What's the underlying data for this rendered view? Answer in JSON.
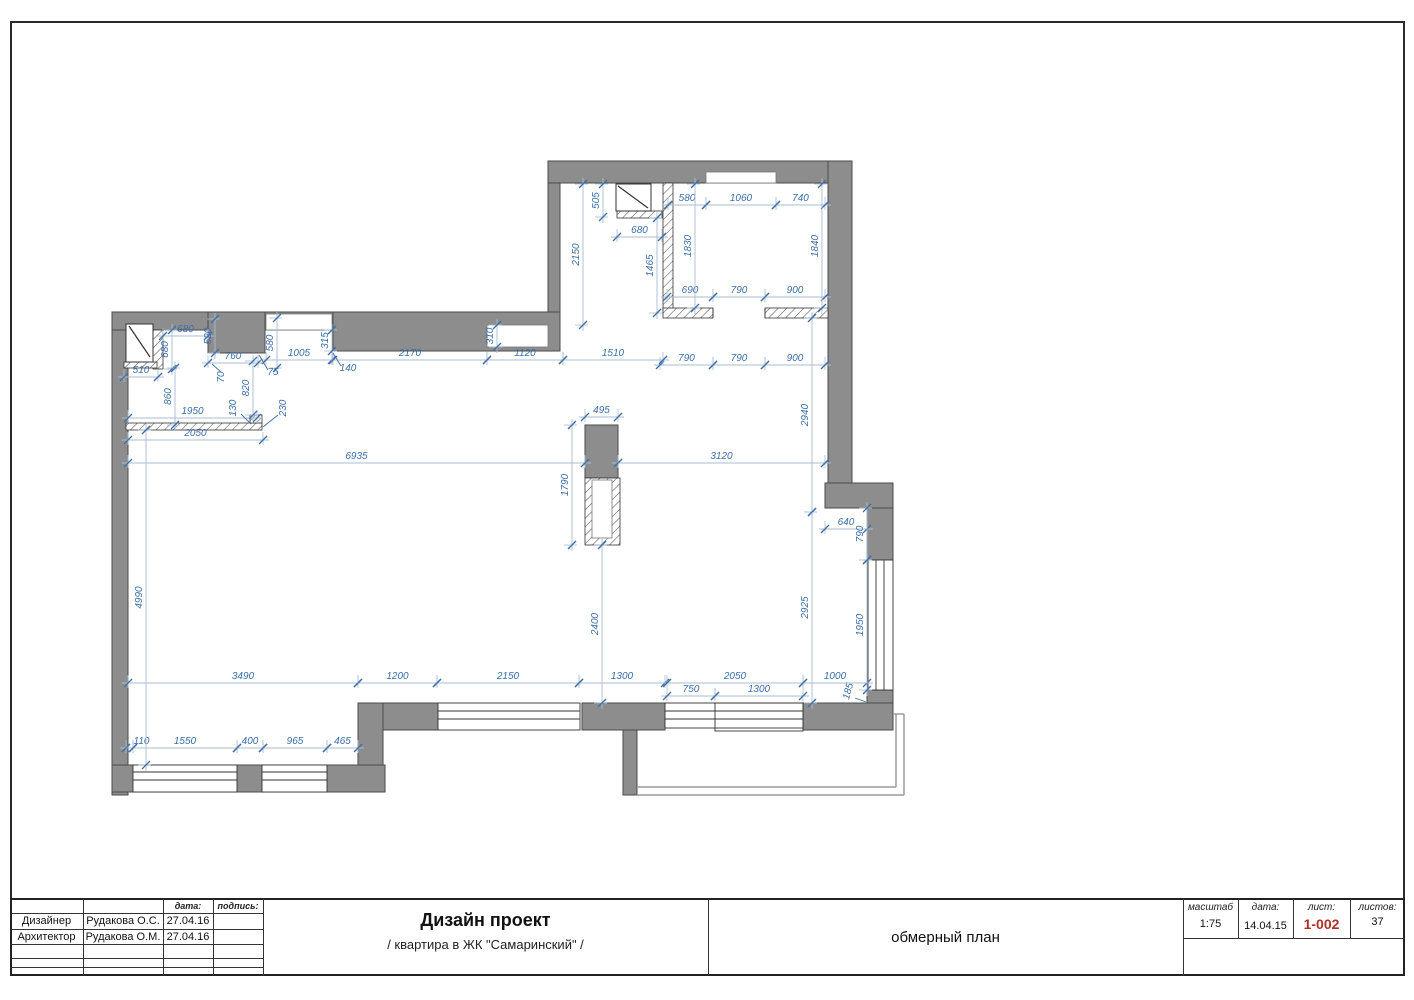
{
  "drawing": {
    "colors": {
      "wall_fill": "#8d8d8d",
      "wall_stroke": "#4a4a4a",
      "hatch_stroke": "#555555",
      "dim_text": "#3a6ea8",
      "dim_line": "#a9bdd3",
      "tick": "#3d6fa8",
      "balcony_line": "#9a9a9a",
      "thin_black": "#333333",
      "sheet_number_red": "#b03028"
    },
    "plan": {
      "walls": [
        [
          112,
          312,
          16,
          483
        ],
        [
          112,
          312,
          221,
          18
        ],
        [
          208,
          312,
          57,
          41
        ],
        [
          333,
          312,
          227,
          39
        ],
        [
          548,
          161,
          12,
          151
        ],
        [
          548,
          161,
          304,
          22
        ],
        [
          828,
          161,
          24,
          322
        ],
        [
          825,
          483,
          68,
          25
        ],
        [
          867,
          508,
          26,
          52
        ],
        [
          867,
          690,
          26,
          13
        ],
        [
          803,
          703,
          90,
          27
        ],
        [
          582,
          703,
          83,
          27
        ],
        [
          623,
          730,
          14,
          65
        ],
        [
          358,
          703,
          80,
          27
        ],
        [
          358,
          703,
          25,
          89
        ],
        [
          112,
          765,
          273,
          27
        ],
        [
          585,
          425,
          33,
          53
        ]
      ],
      "hatched": [
        [
          153,
          330,
          10,
          39
        ],
        [
          124,
          362,
          33,
          6
        ],
        [
          126,
          423,
          136,
          7
        ],
        [
          250,
          415,
          12,
          8
        ],
        [
          663,
          183,
          10,
          130
        ],
        [
          617,
          211,
          45,
          7
        ],
        [
          663,
          308,
          50,
          10
        ],
        [
          765,
          308,
          63,
          10
        ],
        [
          585,
          478,
          35,
          67
        ]
      ],
      "insets": [
        [
          266,
          314,
          66,
          16
        ],
        [
          487,
          325,
          61,
          22
        ],
        [
          706,
          172,
          70,
          11
        ],
        [
          592,
          480,
          20,
          58
        ]
      ],
      "windows": [
        {
          "type": "h",
          "x1": 133,
          "x2": 237,
          "y1": 765,
          "y2": 792,
          "lines": [
            772,
            780
          ]
        },
        {
          "type": "h",
          "x1": 262,
          "x2": 327,
          "y1": 765,
          "y2": 792,
          "lines": [
            772,
            780
          ]
        },
        {
          "type": "h",
          "x1": 438,
          "x2": 580,
          "y1": 703,
          "y2": 730,
          "lines": [
            711,
            719
          ]
        },
        {
          "type": "h",
          "x1": 665,
          "x2": 803,
          "y1": 703,
          "y2": 728,
          "lines": [
            711,
            719
          ]
        },
        {
          "type": "v",
          "x1": 868,
          "x2": 893,
          "y1": 560,
          "y2": 690,
          "lines": [
            876,
            884
          ]
        }
      ],
      "outline_rects": [
        [
          715,
          703,
          88,
          28
        ]
      ],
      "black_lines": [
        [
          713,
          308,
          713,
          318
        ],
        [
          765,
          308,
          765,
          318
        ]
      ],
      "balcony_lines": [
        [
          896,
          714,
          896,
          787
        ],
        [
          904,
          714,
          904,
          795
        ],
        [
          637,
          787,
          896,
          787
        ],
        [
          637,
          795,
          904,
          795
        ],
        [
          893,
          714,
          904,
          714
        ]
      ],
      "doors": [
        {
          "x": 126,
          "y": 324,
          "w": 27,
          "h": 38,
          "d": [
            129,
            326,
            150,
            357
          ]
        },
        {
          "x": 616,
          "y": 184,
          "w": 35,
          "h": 27,
          "d": [
            618,
            186,
            648,
            208
          ]
        }
      ],
      "dims_h": [
        {
          "v": "580",
          "x1": 668,
          "x2": 706,
          "y": 205
        },
        {
          "v": "1060",
          "x1": 706,
          "x2": 776,
          "y": 205
        },
        {
          "v": "740",
          "x1": 776,
          "x2": 825,
          "y": 205
        },
        {
          "v": "680",
          "x1": 617,
          "x2": 662,
          "y": 237
        },
        {
          "v": "690",
          "x1": 667,
          "x2": 713,
          "y": 297
        },
        {
          "v": "790",
          "x1": 713,
          "x2": 765,
          "y": 297
        },
        {
          "v": "900",
          "x1": 765,
          "x2": 825,
          "y": 297
        },
        {
          "v": "790",
          "x1": 660,
          "x2": 713,
          "y": 365
        },
        {
          "v": "790",
          "x1": 713,
          "x2": 765,
          "y": 365
        },
        {
          "v": "900",
          "x1": 765,
          "x2": 825,
          "y": 365
        },
        {
          "v": "680",
          "x1": 163,
          "x2": 208,
          "y": 336
        },
        {
          "v": "510",
          "x1": 124,
          "x2": 158,
          "y": 377
        },
        {
          "v": "760",
          "x1": 208,
          "x2": 258,
          "y": 363
        },
        {
          "v": "1005",
          "x1": 266,
          "x2": 332,
          "y": 360
        },
        {
          "v": "2170",
          "x1": 333,
          "x2": 487,
          "y": 360
        },
        {
          "v": "1120",
          "x1": 487,
          "x2": 563,
          "y": 360
        },
        {
          "v": "1510",
          "x1": 563,
          "x2": 663,
          "y": 360
        },
        {
          "v": "1950",
          "x1": 128,
          "x2": 257,
          "y": 418
        },
        {
          "v": "2050",
          "x1": 128,
          "x2": 263,
          "y": 440
        },
        {
          "v": "495",
          "x1": 585,
          "x2": 618,
          "y": 417
        },
        {
          "v": "6935",
          "x1": 128,
          "x2": 585,
          "y": 463
        },
        {
          "v": "3120",
          "x1": 618,
          "x2": 825,
          "y": 463
        },
        {
          "v": "640",
          "x1": 825,
          "x2": 867,
          "y": 529
        },
        {
          "v": "3490",
          "x1": 128,
          "x2": 358,
          "y": 683
        },
        {
          "v": "1200",
          "x1": 358,
          "x2": 437,
          "y": 683
        },
        {
          "v": "2150",
          "x1": 437,
          "x2": 579,
          "y": 683
        },
        {
          "v": "1300",
          "x1": 579,
          "x2": 665,
          "y": 683
        },
        {
          "v": "2050",
          "x1": 667,
          "x2": 803,
          "y": 683
        },
        {
          "v": "1000",
          "x1": 803,
          "x2": 867,
          "y": 683
        },
        {
          "v": "750",
          "x1": 667,
          "x2": 715,
          "y": 696
        },
        {
          "v": "1300",
          "x1": 715,
          "x2": 803,
          "y": 696
        },
        {
          "v": "110",
          "x1": 126,
          "x2": 133,
          "y": 748,
          "ox": 12
        },
        {
          "v": "1550",
          "x1": 133,
          "x2": 237,
          "y": 748
        },
        {
          "v": "400",
          "x1": 237,
          "x2": 263,
          "y": 748
        },
        {
          "v": "965",
          "x1": 263,
          "x2": 327,
          "y": 748
        },
        {
          "v": "465",
          "x1": 327,
          "x2": 358,
          "y": 748
        }
      ],
      "dims_v": [
        {
          "v": "505",
          "y1": 184,
          "y2": 217,
          "x": 603
        },
        {
          "v": "2150",
          "y1": 184,
          "y2": 325,
          "x": 583
        },
        {
          "v": "1465",
          "y1": 218,
          "y2": 313,
          "x": 657
        },
        {
          "v": "1830",
          "y1": 184,
          "y2": 308,
          "x": 695
        },
        {
          "v": "1840",
          "y1": 184,
          "y2": 308,
          "x": 822
        },
        {
          "v": "680",
          "y1": 330,
          "y2": 369,
          "x": 172
        },
        {
          "v": "520",
          "y1": 319,
          "y2": 353,
          "x": 215
        },
        {
          "v": "580",
          "y1": 318,
          "y2": 368,
          "x": 277
        },
        {
          "v": "315",
          "y1": 330,
          "y2": 351,
          "x": 332
        },
        {
          "v": "310",
          "y1": 325,
          "y2": 347,
          "x": 497
        },
        {
          "v": "860",
          "y1": 368,
          "y2": 425,
          "x": 175
        },
        {
          "v": "820",
          "y1": 361,
          "y2": 415,
          "x": 253
        },
        {
          "v": "2940",
          "y1": 318,
          "y2": 512,
          "x": 812
        },
        {
          "v": "2925",
          "y1": 512,
          "y2": 703,
          "x": 812
        },
        {
          "v": "1790",
          "y1": 425,
          "y2": 545,
          "x": 572
        },
        {
          "v": "2400",
          "y1": 545,
          "y2": 703,
          "x": 602
        },
        {
          "v": "4990",
          "y1": 430,
          "y2": 765,
          "x": 146
        },
        {
          "v": "790",
          "y1": 508,
          "y2": 560,
          "x": 867
        },
        {
          "v": "1950",
          "y1": 560,
          "y2": 690,
          "x": 867
        }
      ],
      "leader_labels": [
        {
          "v": "75",
          "x": 273,
          "y": 375,
          "rot": 0
        },
        {
          "v": "140",
          "x": 348,
          "y": 371,
          "rot": 0
        },
        {
          "v": "70",
          "x": 224,
          "y": 377,
          "rot": -90
        },
        {
          "v": "130",
          "x": 236,
          "y": 408,
          "rot": -90
        },
        {
          "v": "230",
          "x": 286,
          "y": 408,
          "rot": -90
        },
        {
          "v": "185",
          "x": 851,
          "y": 692,
          "rot": -75
        }
      ],
      "leaders": [
        [
          268,
          370,
          259,
          355
        ],
        [
          341,
          366,
          333,
          353
        ],
        [
          221,
          372,
          212,
          364
        ],
        [
          241,
          414,
          251,
          424
        ],
        [
          278,
          415,
          263,
          427
        ],
        [
          855,
          698,
          866,
          702
        ]
      ]
    }
  },
  "title_block": {
    "people": {
      "header_date": "дата:",
      "header_signature": "подпись:",
      "rows": [
        {
          "role": "Дизайнер",
          "name": "Рудакова О.С.",
          "date": "27.04.16"
        },
        {
          "role": "Архитектор",
          "name": "Рудакова О.М.",
          "date": "27.04.16"
        }
      ]
    },
    "project": {
      "title": "Дизайн проект",
      "subtitle": "/ квартира в ЖК \"Самаринский\" /"
    },
    "sheet_name": "обмерный план",
    "stamp": {
      "scale_label": "масштаб",
      "scale_value": "1:75",
      "date_label": "дата:",
      "date_value": "14.04.15",
      "sheet_label": "лист:",
      "sheet_value": "1-002",
      "sheets_label": "листов:",
      "sheets_value": "37"
    }
  }
}
